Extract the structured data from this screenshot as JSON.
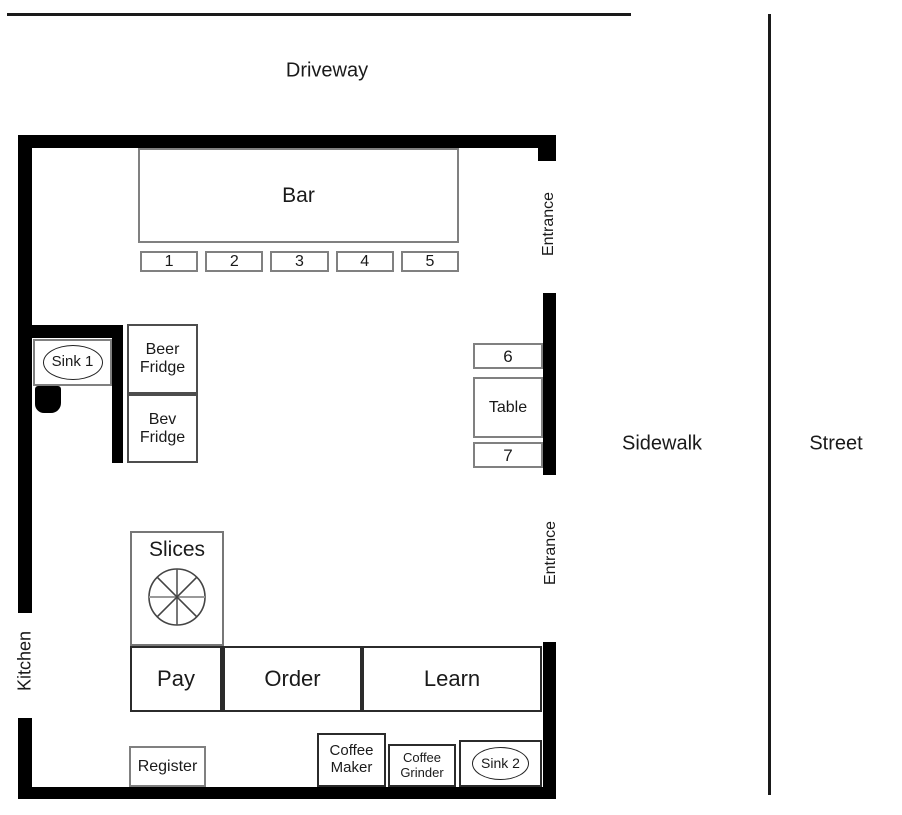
{
  "surroundings": {
    "driveway": "Driveway",
    "sidewalk": "Sidewalk",
    "street": "Street"
  },
  "building": {
    "labels": {
      "kitchen": "Kitchen",
      "entrance_top": "Entrance",
      "entrance_bottom": "Entrance"
    },
    "bar": {
      "label": "Bar",
      "seats": [
        "1",
        "2",
        "3",
        "4",
        "5"
      ]
    },
    "window_table": {
      "label": "Table",
      "seat_top": "6",
      "seat_bottom": "7"
    },
    "counter": {
      "pay": "Pay",
      "order": "Order",
      "learn": "Learn"
    },
    "fixtures": {
      "sink1": "Sink 1",
      "beer_fridge": "Beer\nFridge",
      "bev_fridge": "Bev\nFridge",
      "slices": "Slices",
      "register": "Register",
      "coffee_maker": "Coffee\nMaker",
      "coffee_grinder": "Coffee\nGrinder",
      "sink2": "Sink 2"
    }
  },
  "icons": {
    "slices_icon": "pizza-cut-eight-slices"
  },
  "colors": {
    "wall": "#000000",
    "border_gray": "#808080",
    "border_dark": "#2b2b2b",
    "text": "#1a1a1a"
  }
}
